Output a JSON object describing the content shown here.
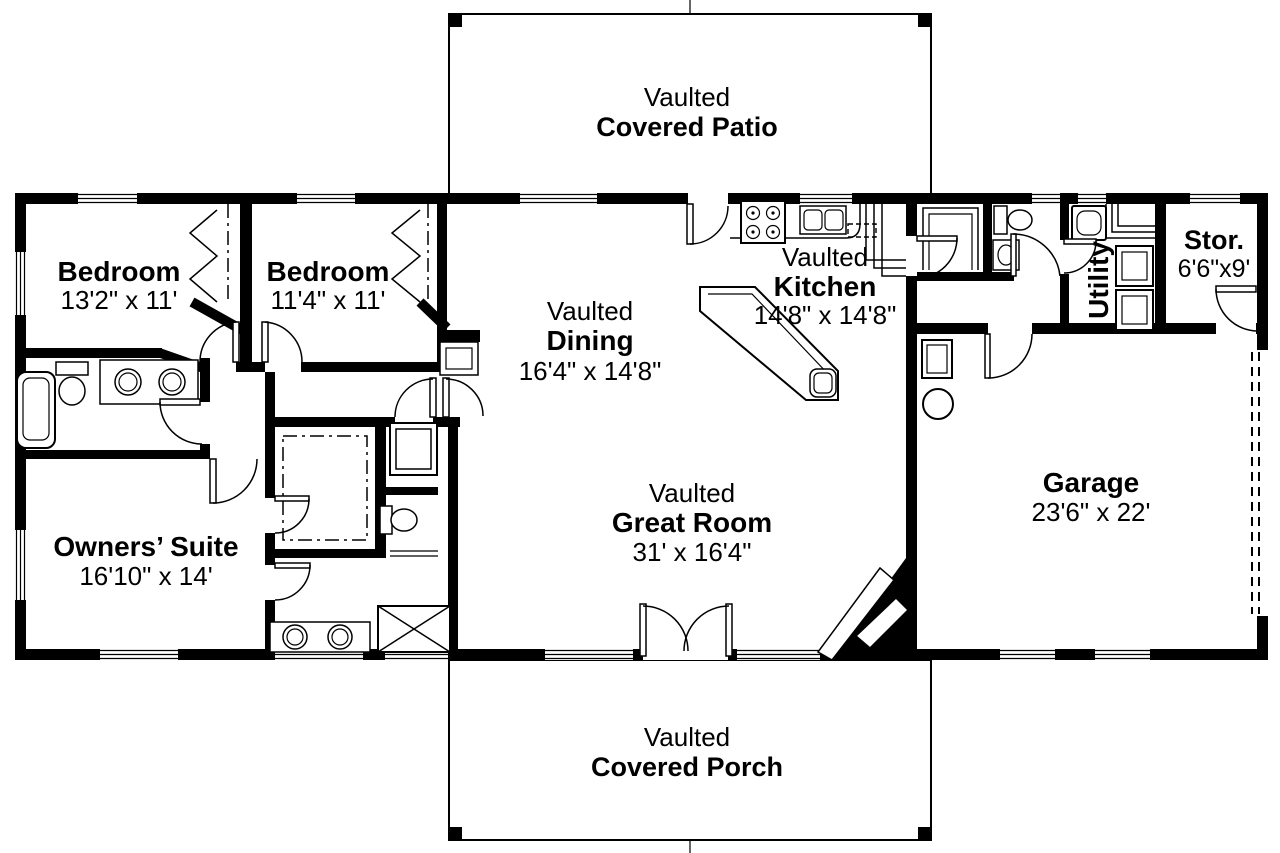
{
  "colors": {
    "ink": "#000000",
    "paper": "#ffffff"
  },
  "plan": {
    "patio": {
      "prefix": "Vaulted",
      "name": "Covered Patio"
    },
    "porch": {
      "prefix": "Vaulted",
      "name": "Covered Porch"
    },
    "rooms": {
      "bedroom1": {
        "name": "Bedroom",
        "dims": "13'2\" x 11'"
      },
      "bedroom2": {
        "name": "Bedroom",
        "dims": "11'4\" x 11'"
      },
      "dining": {
        "prefix": "Vaulted",
        "name": "Dining",
        "dims": "16'4\" x 14'8\""
      },
      "kitchen": {
        "prefix": "Vaulted",
        "name": "Kitchen",
        "dims": "14'8\" x 14'8\""
      },
      "greatRoom": {
        "prefix": "Vaulted",
        "name": "Great Room",
        "dims": "31' x 16'4\""
      },
      "ownersSuite": {
        "name": "Owners’ Suite",
        "dims": "16'10\" x 14'"
      },
      "garage": {
        "name": "Garage",
        "dims": "23'6\" x 22'"
      },
      "utility": {
        "name": "Utility"
      },
      "storage": {
        "name": "Stor.",
        "dims": "6'6\"x9'"
      }
    }
  }
}
